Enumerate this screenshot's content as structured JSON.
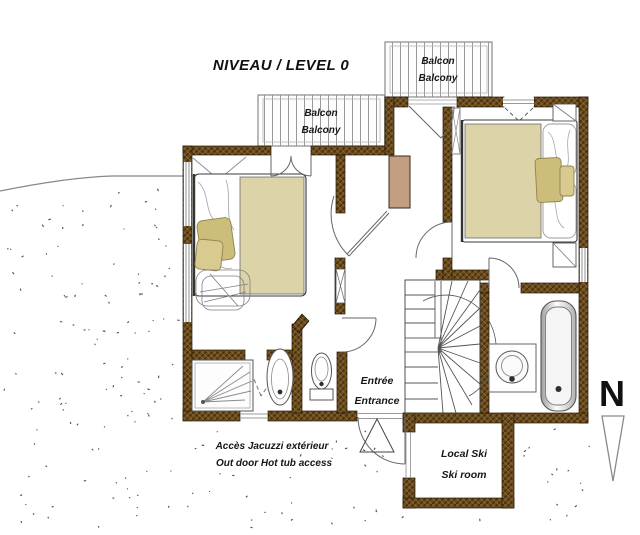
{
  "title": "NIVEAU / LEVEL 0",
  "compass": {
    "letter": "N"
  },
  "labels": {
    "balcony_left": {
      "line1": "Balcon",
      "line2": "Balcony"
    },
    "balcony_right": {
      "line1": "Balcon",
      "line2": "Balcony"
    },
    "entrance": {
      "line1": "Entrée",
      "line2": "Entrance"
    },
    "jacuzzi_access": {
      "line1": "Accès Jacuzzi extérieur",
      "line2": "Out door Hot tub access"
    },
    "ski_room": {
      "line1": "Local Ski",
      "line2": "Ski room"
    }
  },
  "colors": {
    "wall_brown": "#6e4e20",
    "wall_hatch": "#46300f",
    "bed_blanket": "#dcd3a8",
    "pillow_khaki": "#cdbd7a",
    "pillow_khaki_light": "#d9cb8f",
    "chimney_tan": "#c59d83",
    "paper": "#ffffff"
  }
}
